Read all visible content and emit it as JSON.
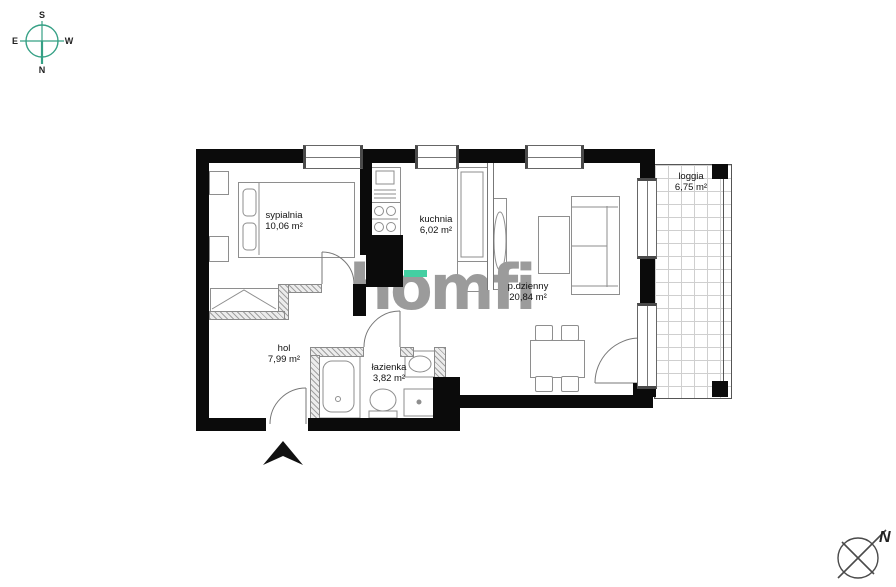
{
  "watermark": {
    "text": "homfi",
    "color": "#9b9b9b",
    "accent_color": "#44cfa2"
  },
  "compass_primary": {
    "south": "S",
    "west": "W",
    "north": "N",
    "east": "E",
    "ring_color": "#35a085"
  },
  "compass_secondary": {
    "north": "N",
    "ring_color": "#4a4a4a"
  },
  "rooms": [
    {
      "name": "sypialnia",
      "area": "10,06 m²"
    },
    {
      "name": "kuchnia",
      "area": "6,02 m²"
    },
    {
      "name": "p.dzienny",
      "area": "20,84 m²"
    },
    {
      "name": "hol",
      "area": "7,99 m²"
    },
    {
      "name": "łazienka",
      "area": "3,82 m²"
    },
    {
      "name": "loggia",
      "area": "6,75 m²"
    }
  ],
  "colors": {
    "wall": "#0b0b0b",
    "furniture_line": "#8e8e8e",
    "window_frame": "#666666",
    "hatch": "#a0a0a0",
    "label_text": "#111111"
  }
}
